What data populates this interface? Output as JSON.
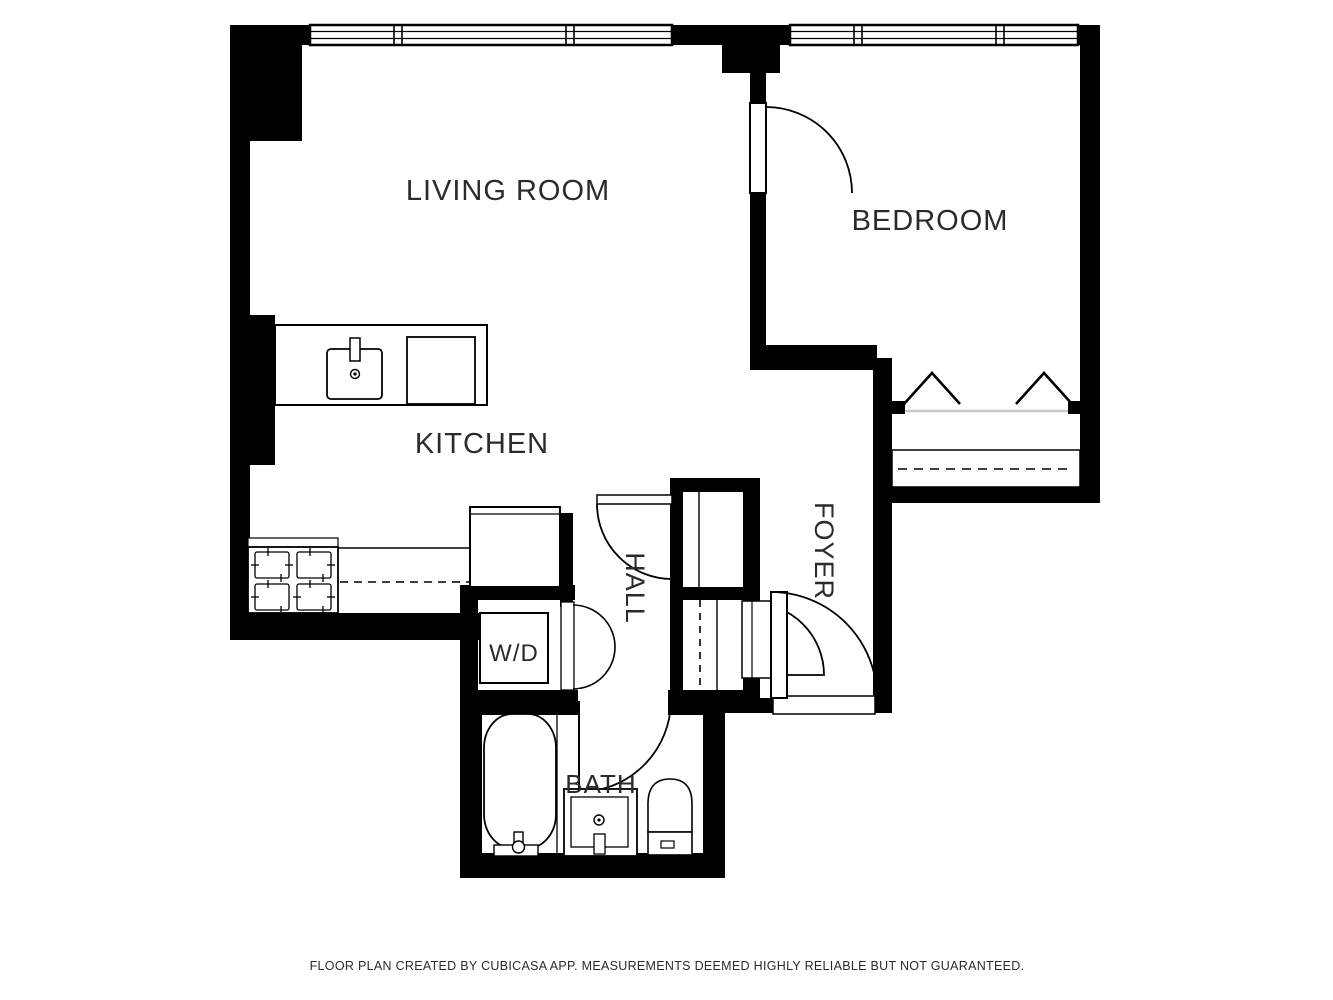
{
  "rooms": {
    "living_room": {
      "label": "LIVING ROOM"
    },
    "bedroom": {
      "label": "BEDROOM"
    },
    "kitchen": {
      "label": "KITCHEN"
    },
    "hall": {
      "label": "HALL"
    },
    "foyer": {
      "label": "FOYER"
    },
    "bath": {
      "label": "BATH"
    },
    "laundry": {
      "label": "W/D"
    }
  },
  "footer": {
    "text": "FLOOR PLAN CREATED BY CUBICASA APP. MEASUREMENTS DEEMED HIGHLY RELIABLE BUT NOT GUARANTEED."
  },
  "fixtures": [
    "kitchen-sink",
    "dishwasher",
    "stove-4-burner",
    "refrigerator",
    "kitchen-counter",
    "washer-dryer",
    "bathtub",
    "vanity-sink",
    "toilet",
    "bedroom-closet-rod",
    "clothes-hangers",
    "entry-door",
    "windows"
  ],
  "colors": {
    "wall": "#000000",
    "floor": "#ffffff",
    "label": "#2b2b2b",
    "closet_rail": "#c8c8c8"
  }
}
